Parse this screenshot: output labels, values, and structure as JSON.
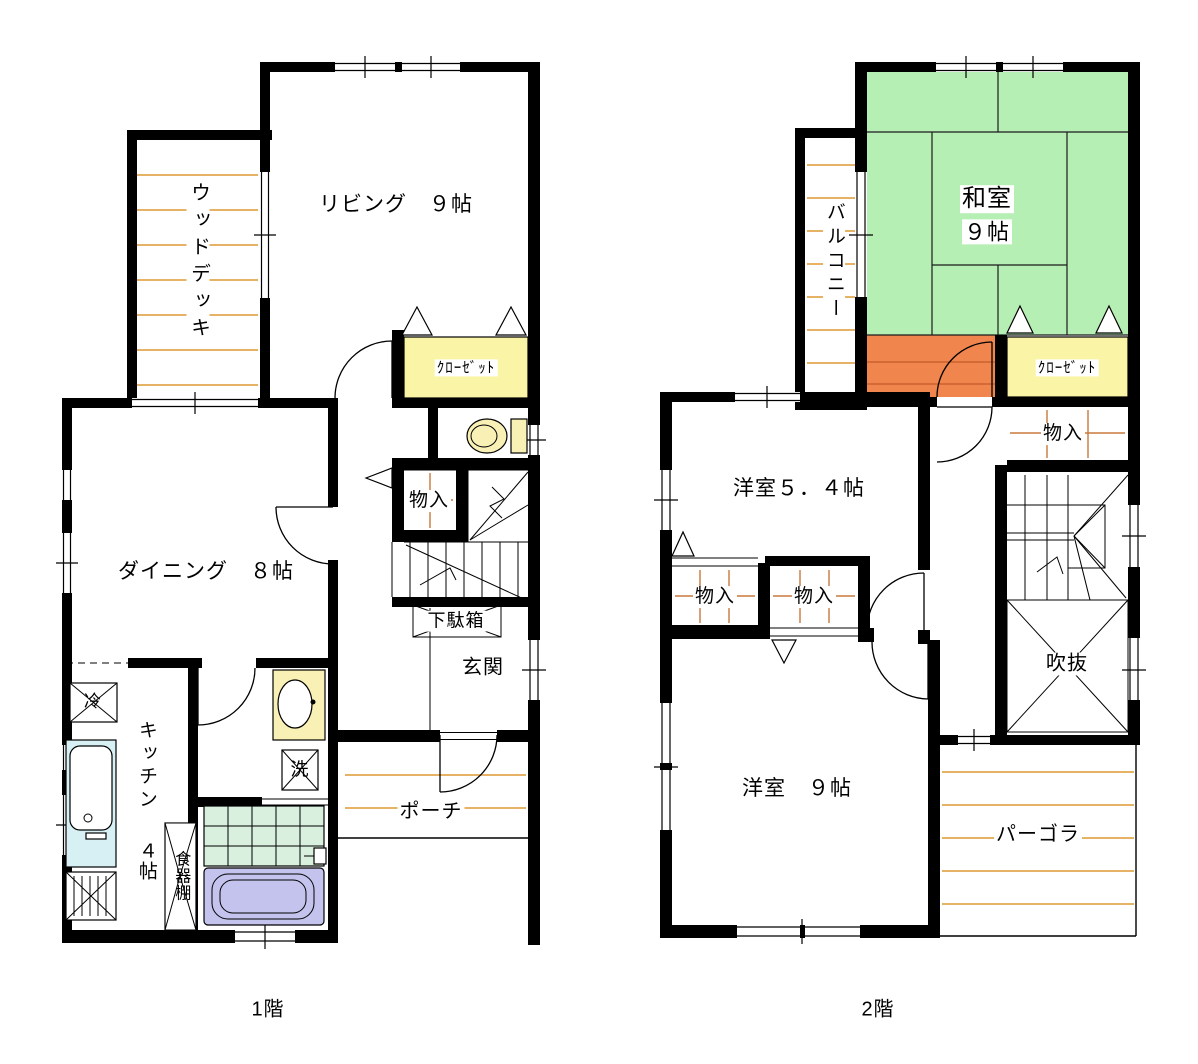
{
  "floor1": {
    "caption": "1階",
    "rooms": {
      "living": "リビング　９帖",
      "wood_deck": "ウッドデッキ",
      "closet": "ｸﾛｰｾﾞｯﾄ",
      "storage": "物入",
      "shoe_cabinet": "下駄箱",
      "entrance": "玄関",
      "dining": "ダイニング　８帖",
      "kitchen": "キッチン",
      "kitchen_size": "４帖",
      "cupboard": "食器棚",
      "fridge": "冷",
      "laundry": "洗",
      "porch": "ポーチ"
    }
  },
  "floor2": {
    "caption": "2階",
    "rooms": {
      "balcony": "バルコニー",
      "japanese_room": "和室",
      "japanese_room_size": "９帖",
      "closet": "ｸﾛｰｾﾞｯﾄ",
      "storage": "物入",
      "western_room_54": "洋室５．４帖",
      "void": "吹抜",
      "western_room_9": "洋室　９帖",
      "pergola": "パーゴラ"
    }
  },
  "colors": {
    "wall": "#000000",
    "tatami_green": "#b6efb4",
    "closet_yellow": "#faf4a6",
    "hall_orange": "#f0854e",
    "deck_line_orange": "#dd9933",
    "shelf_line_orange": "#c8783c",
    "bath_tile_green": "#d9f0de",
    "bathtub_lavender": "#c3c3ee",
    "counter_cyan": "#d7f0f4",
    "fixture_yellow": "#f8f0b4"
  }
}
